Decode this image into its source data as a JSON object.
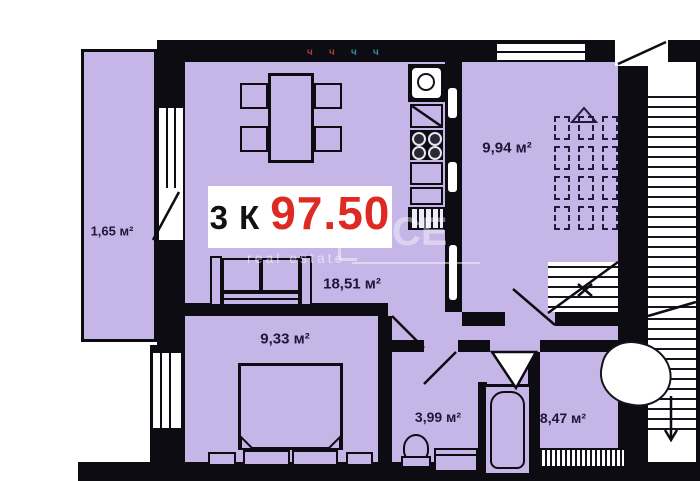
{
  "plan_type": "apartment-floor-plan",
  "badge": {
    "rooms": "3 К",
    "area": "97.50"
  },
  "rooms": [
    {
      "name": "balcony",
      "label": "1,65 м²"
    },
    {
      "name": "living-kitchen",
      "label": "18,51 м²"
    },
    {
      "name": "room-top-right",
      "label": "9,94 м²"
    },
    {
      "name": "bedroom",
      "label": "9,33 м²"
    },
    {
      "name": "bathroom",
      "label": "3,99 м²"
    },
    {
      "name": "entrance-hall",
      "label": "8,47 м²"
    }
  ],
  "watermark": {
    "logo": "CE",
    "tagline": "real estate"
  },
  "wall_marks": [
    {
      "char": "ч",
      "color": "#a83c3c"
    },
    {
      "char": "ч",
      "color": "#a83c3c"
    },
    {
      "char": "ч",
      "color": "#2e8f96"
    },
    {
      "char": "ч",
      "color": "#2e8f96"
    }
  ],
  "colors": {
    "room_fill": "#c6b5e7",
    "wall": "#0d0c12",
    "price_red": "#dd2b24",
    "label_ink": "#201638",
    "background": "#ffffff"
  }
}
